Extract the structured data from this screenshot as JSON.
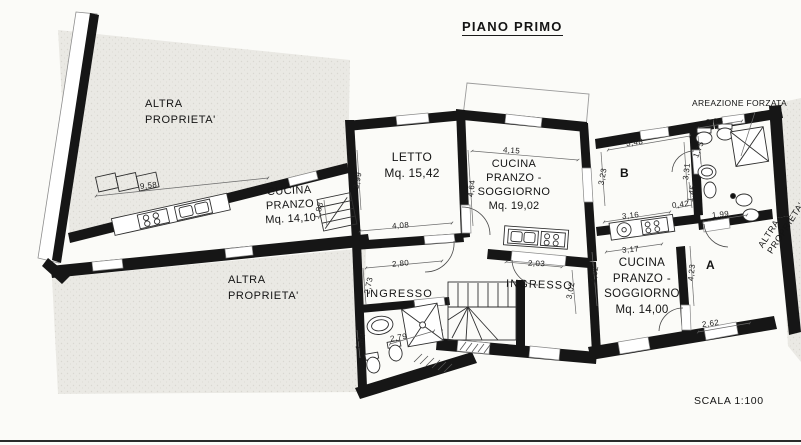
{
  "title": "PIANO PRIMO",
  "scale_label": "SCALA 1:100",
  "notes": {
    "areazione": "AREAZIONE FORZATA",
    "altra_top_left": {
      "l1": "ALTRA",
      "l2": "PROPRIETA'"
    },
    "altra_bottom_left": {
      "l1": "ALTRA",
      "l2": "PROPRIETA'"
    },
    "altra_right": {
      "l1": "ALTRA",
      "l2": "PROPRIETA'"
    }
  },
  "rooms": {
    "cucina_pranzo": {
      "l1": "CUCINA",
      "l2": "PRANZO",
      "l3": "Mq. 14,10"
    },
    "letto": {
      "l1": "LETTO",
      "l2": "Mq. 15,42"
    },
    "cucina_soggiorno_19": {
      "l1": "CUCINA",
      "l2": "PRANZO -",
      "l3": "SOGGIORNO",
      "l4": "Mq. 19,02"
    },
    "cucina_soggiorno_14": {
      "l1": "CUCINA",
      "l2": "PRANZO -",
      "l3": "SOGGIORNO",
      "l4": "Mq. 14,00"
    },
    "ingresso_left": "INGRESSO",
    "ingresso_right": "INGRESSO",
    "room_a": "A",
    "room_b": "B"
  },
  "dimensions": {
    "d958": "9,58",
    "d399": "3,99",
    "d188": "1,88",
    "d408": "4,08",
    "d464": "4,64",
    "d415": "4,15",
    "d203": "2,03",
    "d280": "2,80",
    "d273": "2,73",
    "d279": "2,79",
    "d184": "1,84",
    "d302": "3,02",
    "d348": "3,48",
    "d323": "3,23",
    "d331": "3,31",
    "d316": "3,16",
    "d042": "0,42",
    "d175": "1,75",
    "d145": "1,45",
    "d199": "1,99",
    "d234": "2,34",
    "d317": "3,17",
    "d402": "4,02",
    "d423": "4,23",
    "d262": "2,62"
  },
  "colors": {
    "wall": "#161616",
    "paper": "#fbfbf8",
    "outside": "#eae9e4",
    "line": "#555555"
  }
}
